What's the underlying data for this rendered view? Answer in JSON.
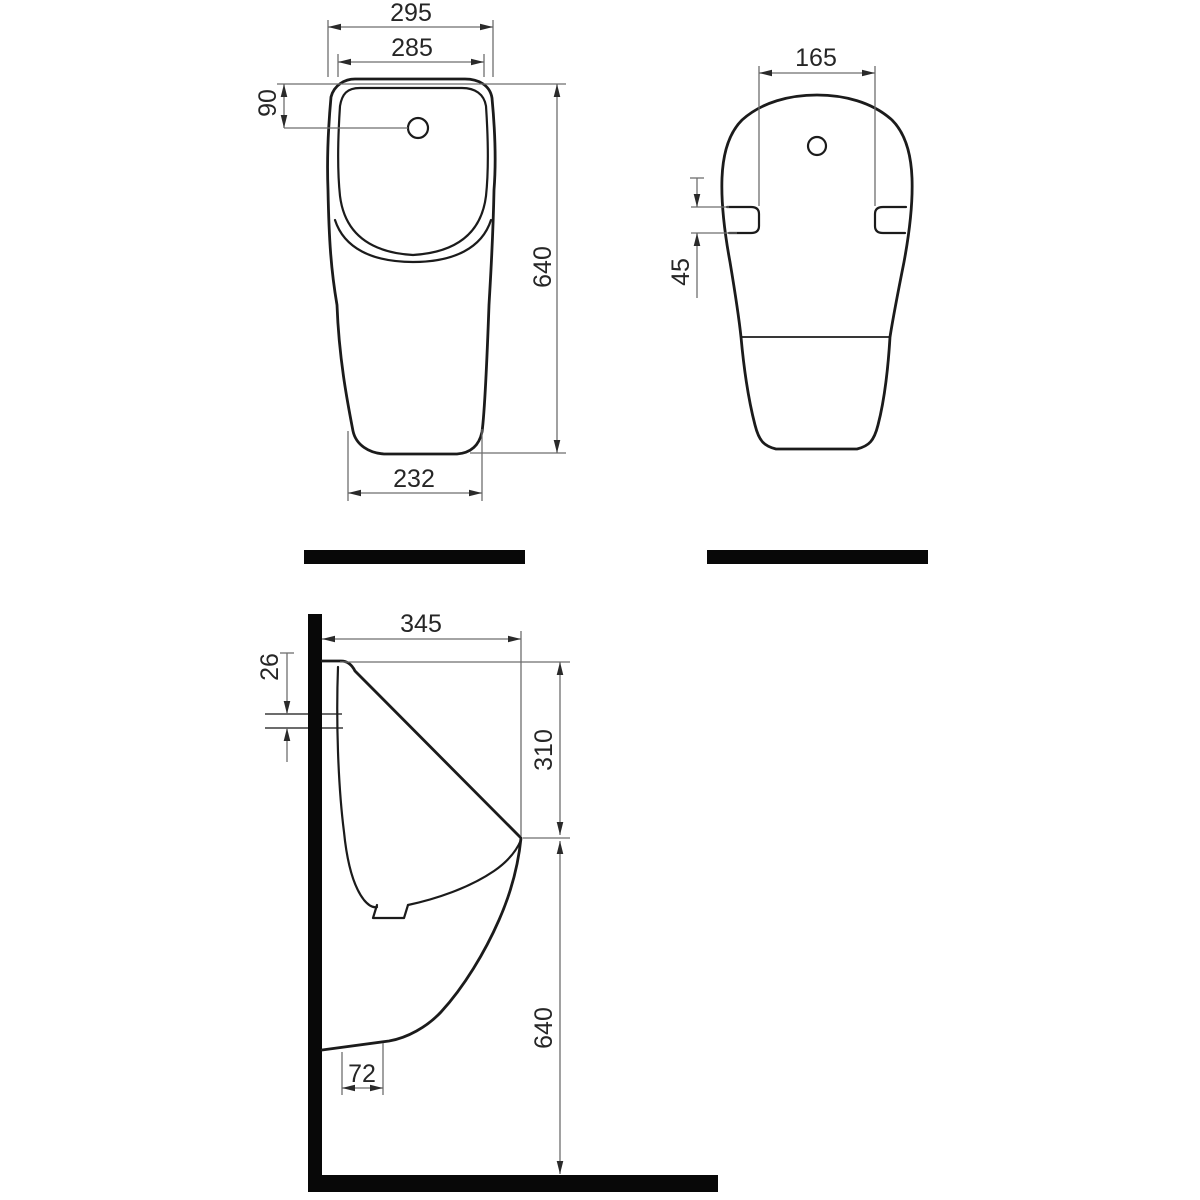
{
  "views": {
    "front": {
      "outer_width": "295",
      "inner_width": "285",
      "hole_offset": "90",
      "height": "640",
      "base_width": "232"
    },
    "back": {
      "bracket_spacing": "165",
      "bracket_height": "45"
    },
    "side": {
      "depth": "345",
      "slot_height": "26",
      "top_to_spout": "310",
      "height": "640",
      "outlet_offset": "72"
    }
  },
  "colors": {
    "outline": "#1b1b1b",
    "dimension_line": "#6e6e6e",
    "dimension_text": "#262626",
    "section_fill": "#080808",
    "background": "#ffffff"
  }
}
